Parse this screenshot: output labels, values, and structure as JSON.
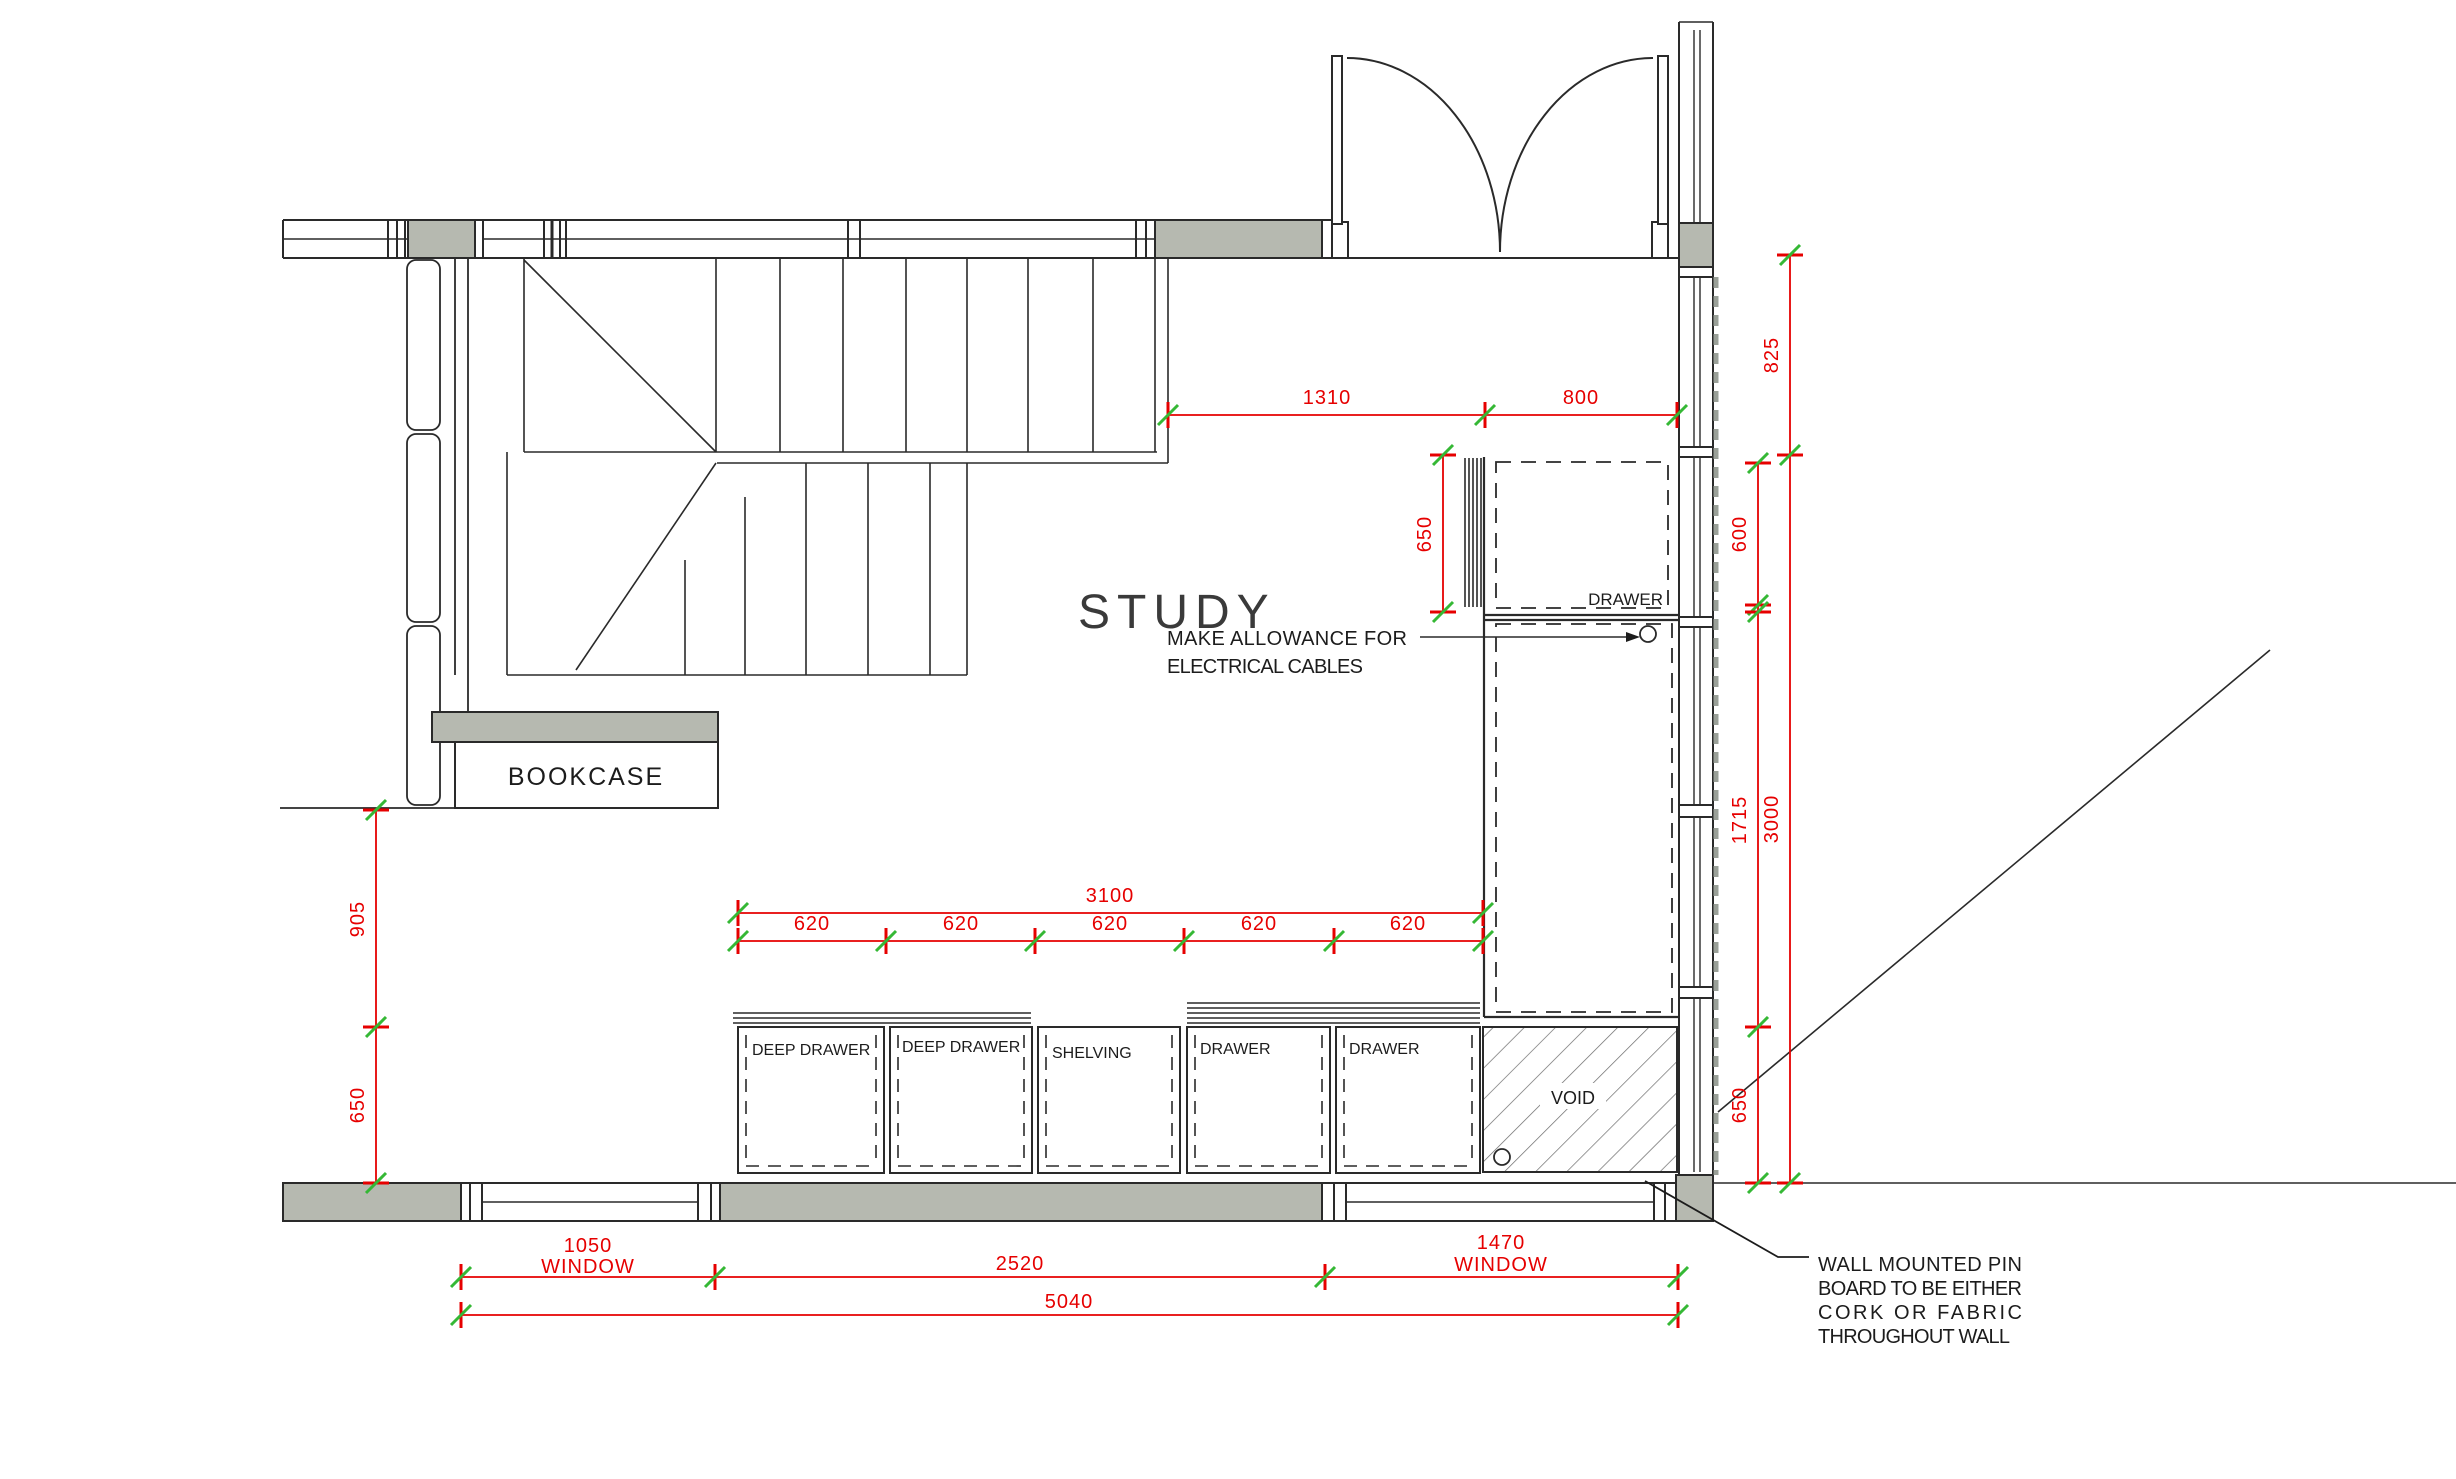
{
  "room": {
    "study_label": "STUDY",
    "bookcase_label": "BOOKCASE",
    "void_label": "VOID",
    "drawer_label": "DRAWER"
  },
  "cabinets": {
    "labels": [
      "DEEP DRAWER",
      "DEEP DRAWER",
      "SHELVING",
      "DRAWER",
      "DRAWER"
    ]
  },
  "annotations": {
    "electrical": {
      "line1": "MAKE ALLOWANCE FOR",
      "line2": "ELECTRICAL CABLES"
    },
    "pinboard": {
      "line1": "WALL MOUNTED PIN",
      "line2": "BOARD TO BE EITHER",
      "line3": "CORK OR FABRIC",
      "line4": "THROUGHOUT WALL"
    }
  },
  "dimensions": {
    "top": {
      "d1310": "1310",
      "d800": "800"
    },
    "right": {
      "d825": "825",
      "d600": "600",
      "d1715": "1715",
      "d650": "650",
      "d3000": "3000"
    },
    "left": {
      "d905": "905",
      "d650": "650"
    },
    "desk": {
      "d650": "650"
    },
    "cabinet_run": {
      "total": "3100",
      "units": [
        "620",
        "620",
        "620",
        "620",
        "620"
      ]
    },
    "bottom": {
      "w1050": "1050",
      "w1050_label": "WINDOW",
      "d2520": "2520",
      "w1470": "1470",
      "w1470_label": "WINDOW",
      "total": "5040"
    }
  },
  "colors": {
    "dimension_red": "#e60000",
    "tick_green": "#35b835",
    "wall_grey": "#b6b9b0",
    "line_black": "#2a2a2a"
  }
}
